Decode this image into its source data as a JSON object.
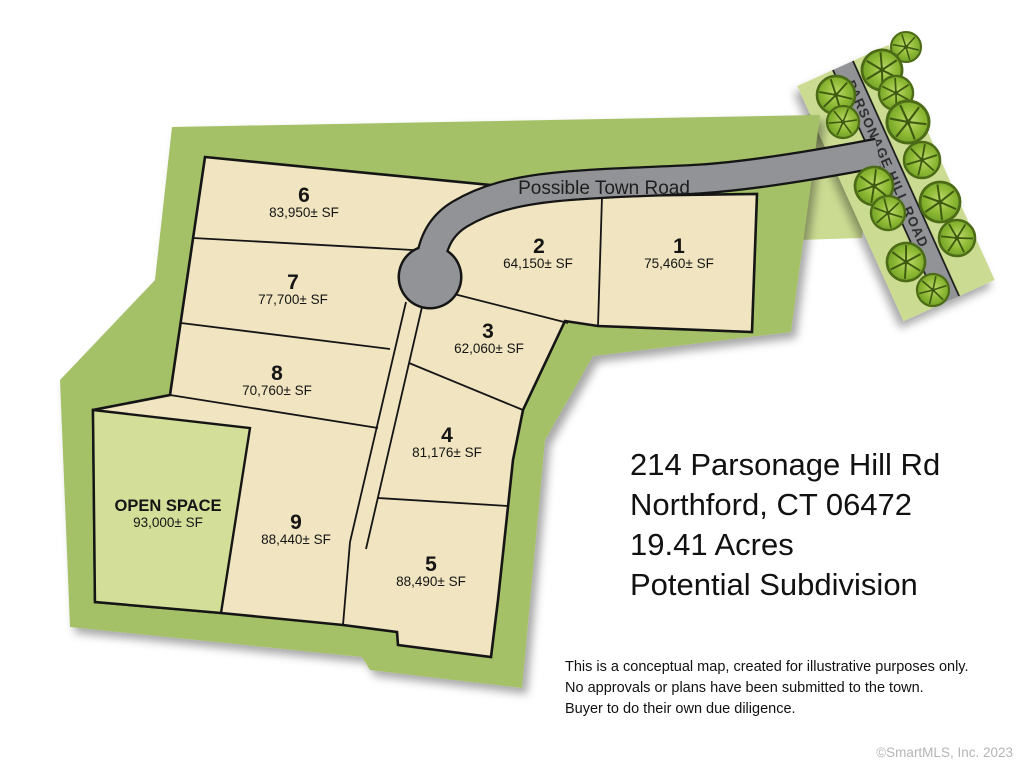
{
  "map": {
    "road_label": "Possible Town Road",
    "street_label": "PARSONAGE HILL ROAD",
    "open_space": {
      "label": "OPEN SPACE",
      "area": "93,000± SF"
    },
    "lots": [
      {
        "num": "1",
        "area": "75,460± SF"
      },
      {
        "num": "2",
        "area": "64,150± SF"
      },
      {
        "num": "3",
        "area": "62,060± SF"
      },
      {
        "num": "4",
        "area": "81,176± SF"
      },
      {
        "num": "5",
        "area": "88,490± SF"
      },
      {
        "num": "6",
        "area": "83,950± SF"
      },
      {
        "num": "7",
        "area": "77,700± SF"
      },
      {
        "num": "8",
        "area": "70,760± SF"
      },
      {
        "num": "9",
        "area": "88,440± SF"
      }
    ],
    "colors": {
      "boundary_band": "#a5c167",
      "lot_fill": "#f0e5c0",
      "open_space_fill": "#d3df99",
      "street_strip": "#cbdc92",
      "road_gray": "#919396",
      "outline_black": "#151515",
      "tree_green": "#7fae2c"
    }
  },
  "title_block": {
    "line1": "214 Parsonage Hill Rd",
    "line2": "Northford, CT 06472",
    "line3": "19.41 Acres",
    "line4": "Potential Subdivision"
  },
  "disclaimer": {
    "line1": "This is a conceptual map, created for illustrative purposes only.",
    "line2": "No approvals or plans have been submitted to the town.",
    "line3": "Buyer to do their own due diligence."
  },
  "watermark": "©SmartMLS, Inc.  2023"
}
